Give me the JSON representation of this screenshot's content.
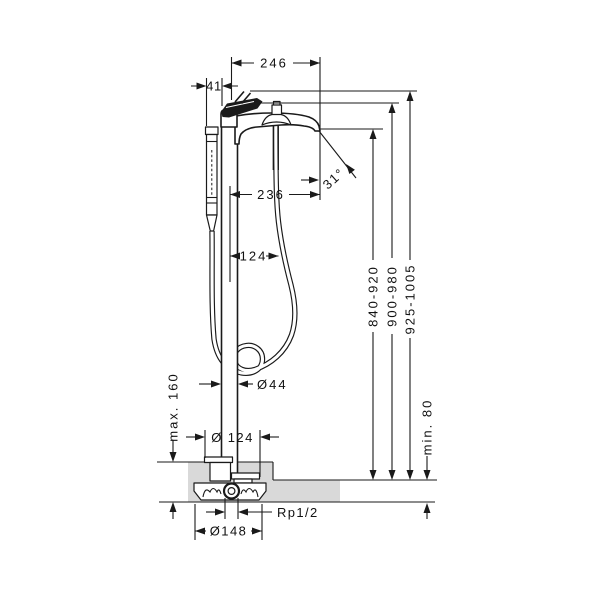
{
  "drawing": {
    "horizontal_dims": {
      "spout_projection": "246",
      "handshower_offset": "41",
      "outlet_projection": "236",
      "hose_offset": "124",
      "pillar_diameter": "Ø44",
      "escutcheon_diameter": "Ø 124",
      "flange_diameter": "Ø148"
    },
    "vertical_dims": {
      "outlet_height": "840-920",
      "spout_top_height": "900-980",
      "overall_height": "925-1005",
      "floor_buildup_max": "max. 160",
      "floor_buildup_min": "min. 80"
    },
    "angle": "31°",
    "connection_thread": "Rp1/2",
    "colors": {
      "line": "#1a1a1a",
      "floor_fill": "#d9d9d9",
      "background": "#ffffff"
    }
  }
}
